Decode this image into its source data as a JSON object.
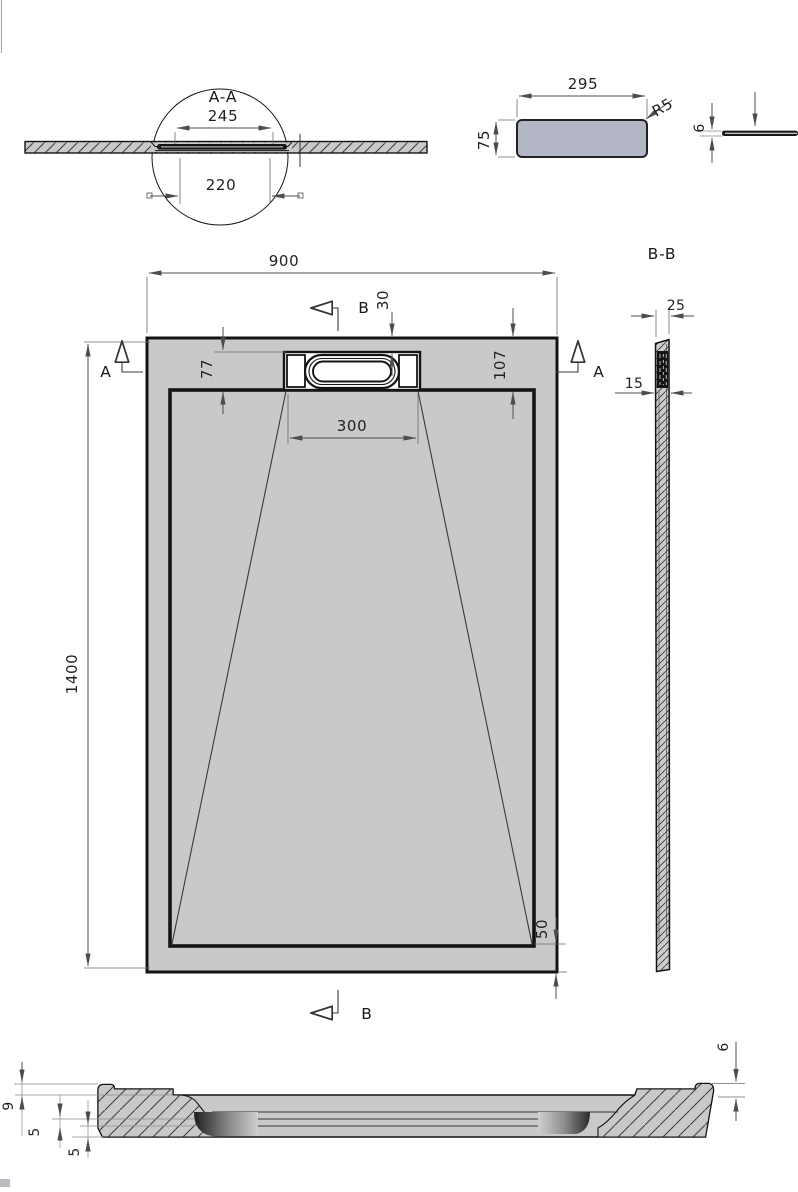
{
  "drawing": {
    "detail_aa": {
      "label": "A-A",
      "dim_width_top": "245",
      "dim_width_bottom": "220"
    },
    "cover_plan": {
      "dim_width": "295",
      "dim_height": "75",
      "corner_radius": "R5"
    },
    "cover_side": {
      "dim_thickness": "6"
    },
    "plan": {
      "dim_width": "900",
      "dim_length": "1400",
      "dim_drain_width": "300",
      "dim_drain_offset": "77",
      "dim_top_offset": "30",
      "dim_right_offset": "107",
      "dim_bottom_border": "50",
      "section_a_label": "A",
      "section_b_label": "B"
    },
    "section_bb": {
      "label": "B-B",
      "dim_top_width": "25",
      "dim_wall": "15"
    },
    "profile": {
      "dim_rim": "9",
      "dim_flange_upper": "5",
      "dim_flange_lower": "5",
      "dim_edge": "6"
    },
    "colors": {
      "tray_fill": "#c9c9c9",
      "cover_fill": "#b3b7c5",
      "outline": "#141414",
      "dim": "#4d4d4d"
    }
  }
}
